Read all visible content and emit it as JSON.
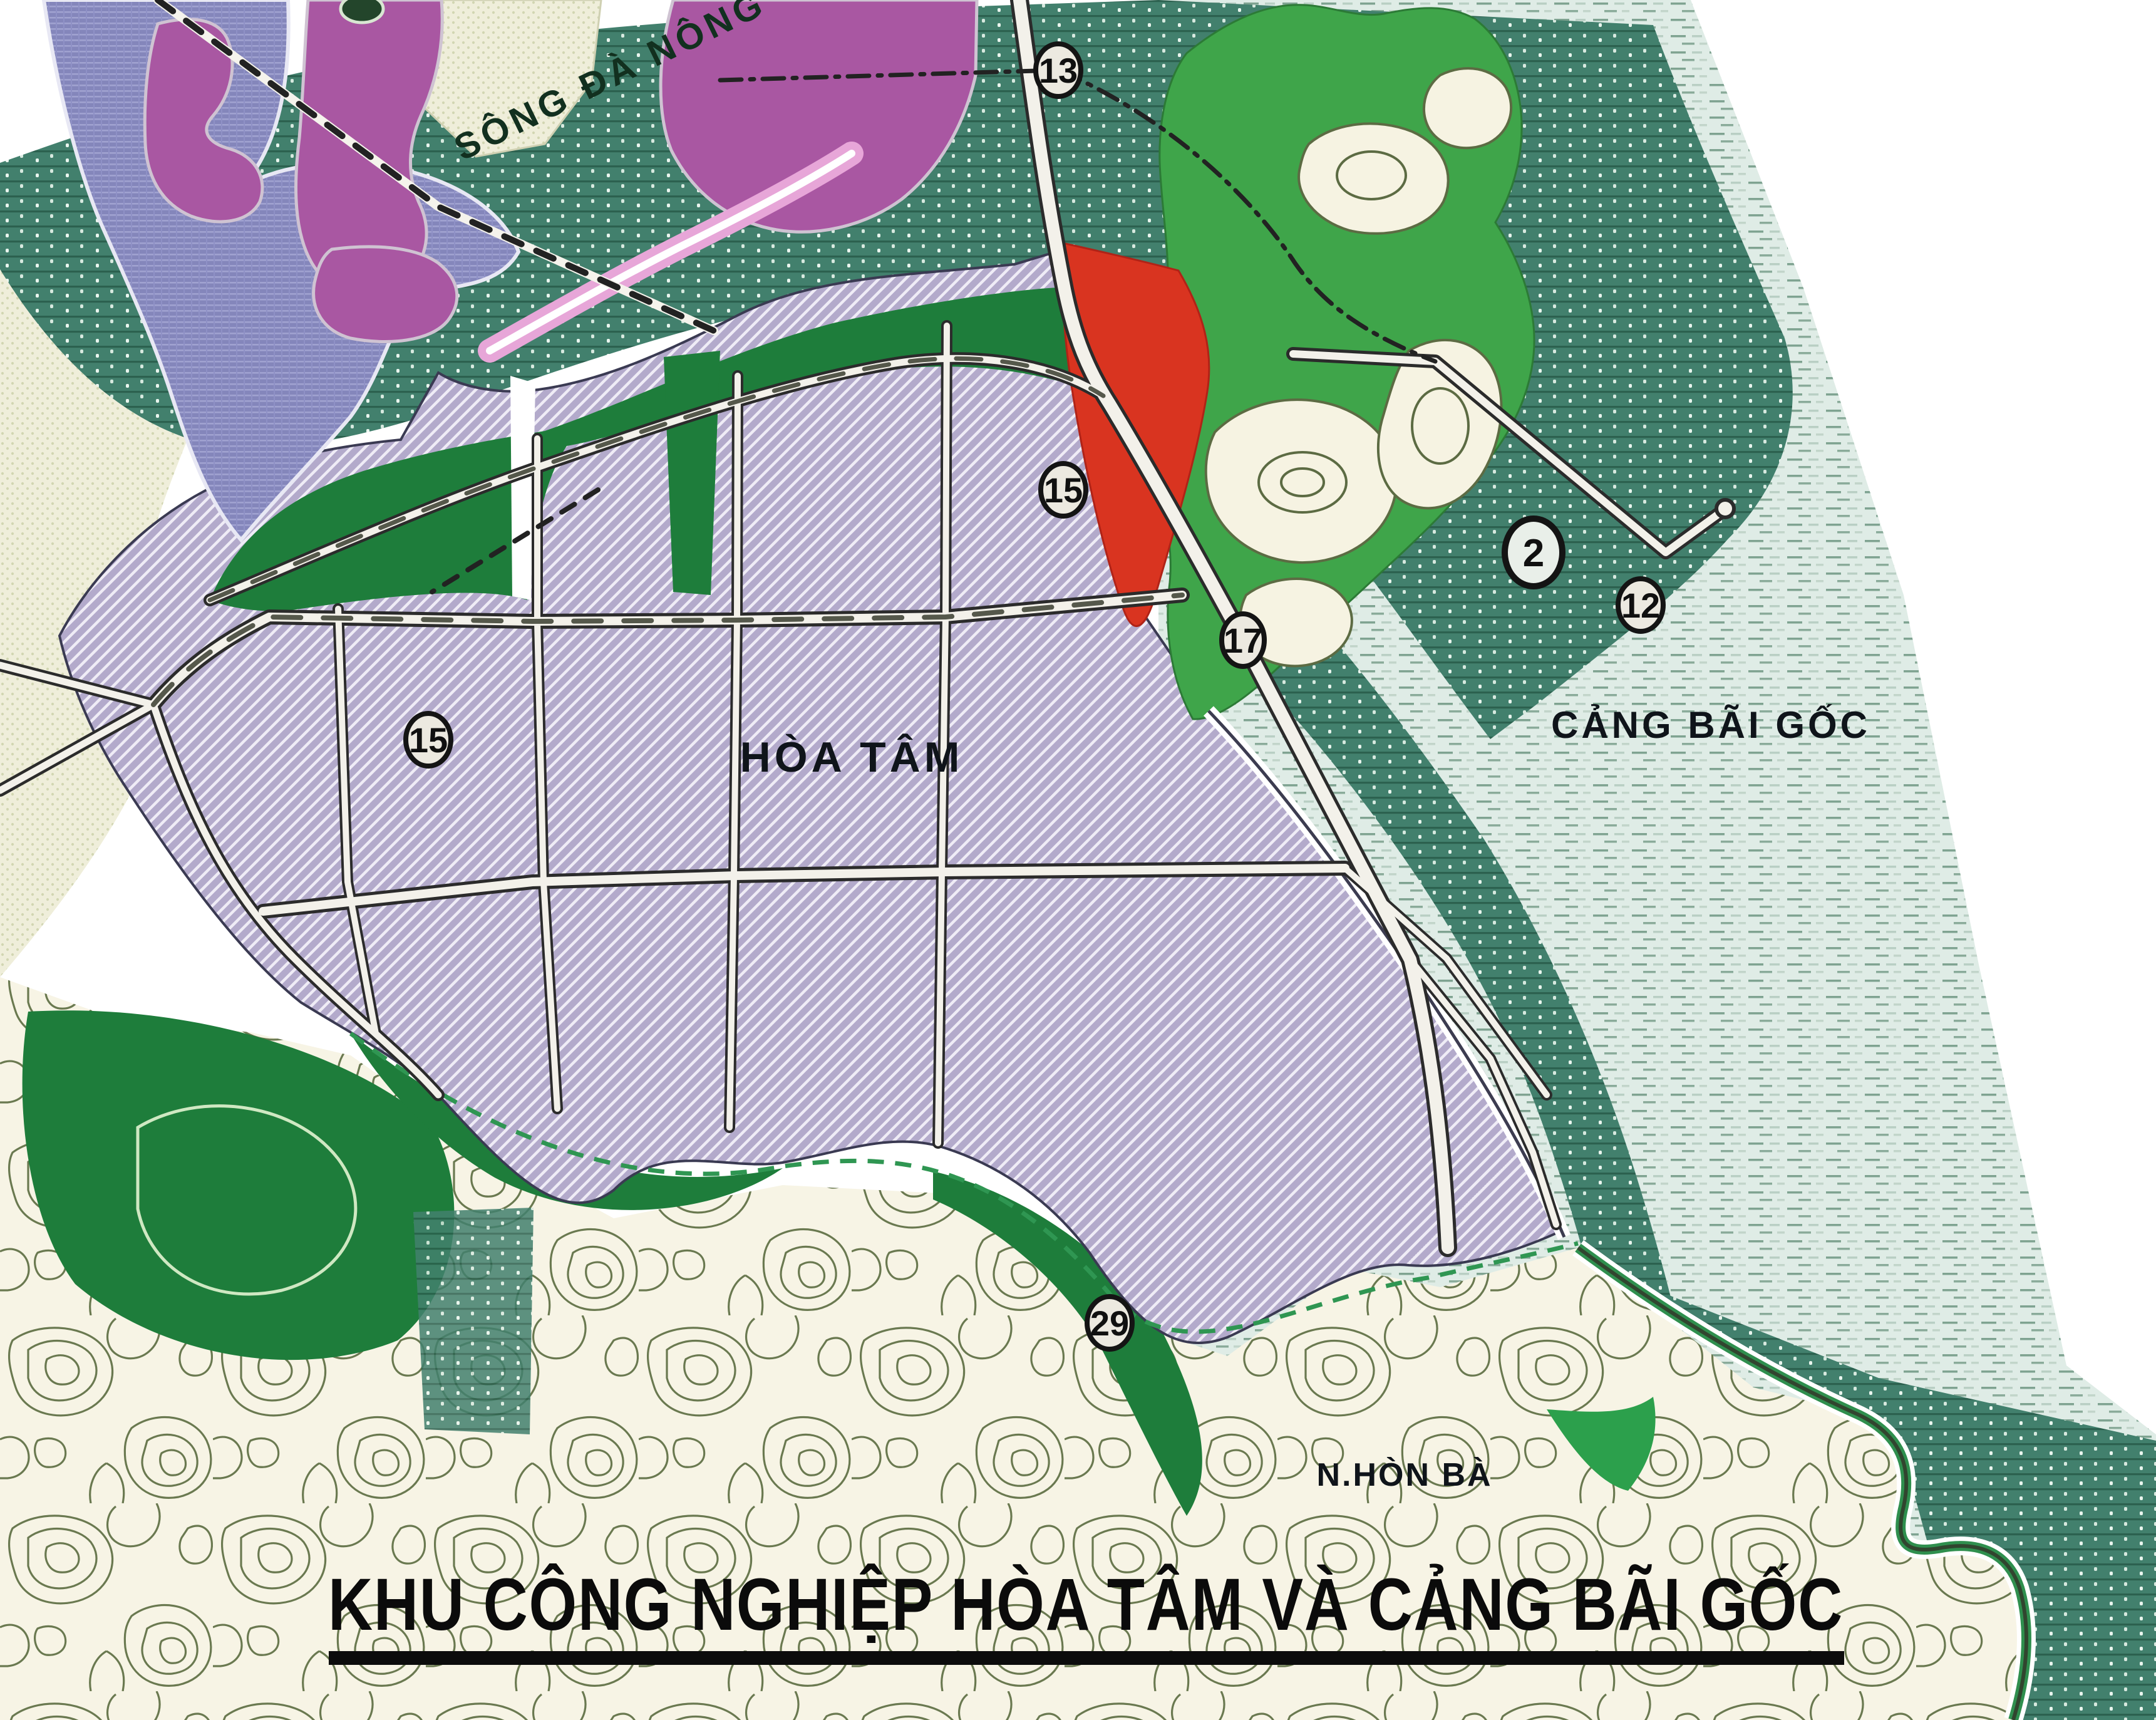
{
  "map": {
    "title": "KHU CÔNG NGHIỆP HÒA TÂM VÀ CẢNG BÃI GỐC",
    "labels": {
      "river": "SÔNG ĐÀ NÔNG",
      "zone": "HÒA TÂM",
      "port": "CẢNG BÃI GỐC",
      "mountain": "N.HÒN BÀ"
    },
    "markers": [
      {
        "value": "13"
      },
      {
        "value": "15"
      },
      {
        "value": "2"
      },
      {
        "value": "12"
      },
      {
        "value": "17"
      },
      {
        "value": "15"
      },
      {
        "value": "29"
      }
    ],
    "colors": {
      "sea_dark": "#42806d",
      "sea_light": "#dfece6",
      "vegetation_dark": "#1e7d3b",
      "island_green": "#3fa54a",
      "industrial_lavender": "#b3aacb",
      "residential_violet": "#8486bb",
      "agriculture_cream": "#efeeda",
      "magenta_zone": "#a957a2",
      "red_zone": "#d93420",
      "contour_olive": "#6a7950",
      "road_fill": "#f3f1ea"
    }
  }
}
